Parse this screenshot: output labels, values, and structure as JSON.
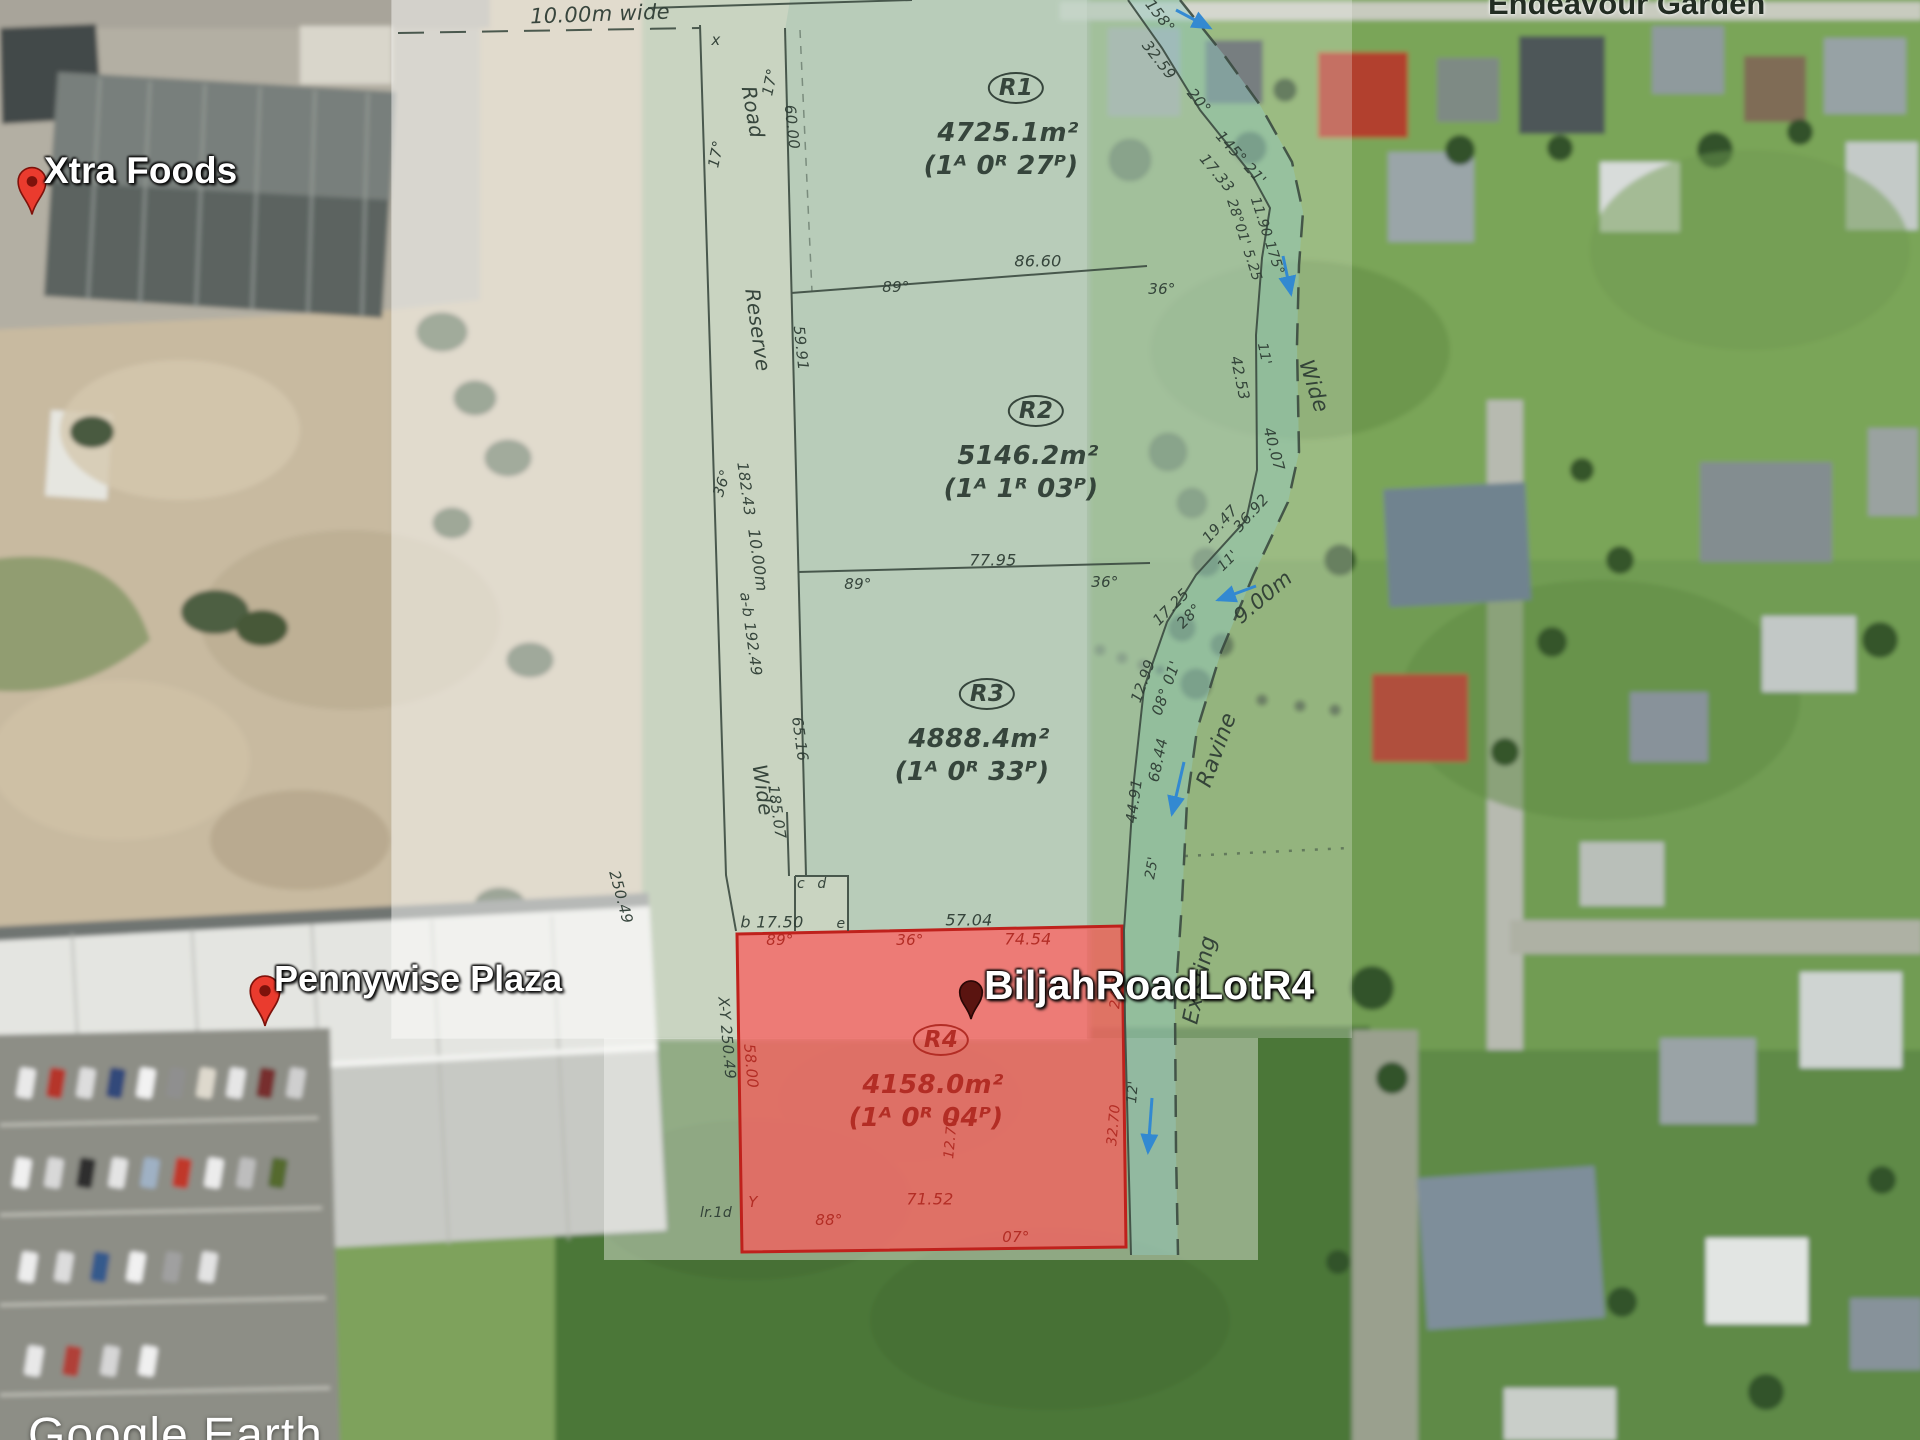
{
  "app": {
    "name": "Google Earth",
    "attribution": "Google Earth"
  },
  "placemarks": [
    {
      "id": "xtra-foods",
      "label": "Xtra Foods",
      "pin": "red-pin-icon"
    },
    {
      "id": "pennywise-plaza",
      "label": "Pennywise Plaza",
      "pin": "red-pin-icon"
    },
    {
      "id": "biljah-road-lot-r4",
      "label": "BiljahRoadLotR4",
      "pin": "dark-pin-icon"
    },
    {
      "id": "endeavour-garden",
      "label": "Endeavour Garden",
      "pin": null
    }
  ],
  "plan": {
    "colors": {
      "ink": "#2f3e35",
      "red": "#b02a22"
    },
    "lots": [
      {
        "id": "R1",
        "area_m2": "4725.1m²",
        "acreage": "(1ᴬ 0ᴿ 27ᴾ)",
        "x": 1016,
        "y": 88,
        "c": "ink"
      },
      {
        "id": "R2",
        "area_m2": "5146.2m²",
        "acreage": "(1ᴬ 1ᴿ 03ᴾ)",
        "x": 1036,
        "y": 411,
        "c": "ink"
      },
      {
        "id": "R3",
        "area_m2": "4888.4m²",
        "acreage": "(1ᴬ 0ᴿ 33ᴾ)",
        "x": 987,
        "y": 694,
        "c": "ink"
      },
      {
        "id": "R4",
        "area_m2": "4158.0m²",
        "acreage": "(1ᴬ 0ᴿ 04ᴾ)",
        "x": 941,
        "y": 1040,
        "c": "red"
      }
    ],
    "labels": [
      {
        "t": "10.00m wide",
        "x": 600,
        "y": 14,
        "s": 21,
        "r": -2
      },
      {
        "t": "x",
        "x": 716,
        "y": 40,
        "s": 15
      },
      {
        "t": "17°",
        "x": 770,
        "y": 82,
        "r": -78
      },
      {
        "t": "Road",
        "x": 753,
        "y": 112,
        "s": 20,
        "r": 80
      },
      {
        "t": "17°",
        "x": 716,
        "y": 154,
        "r": -78
      },
      {
        "t": "60.00",
        "x": 792,
        "y": 127,
        "r": 84
      },
      {
        "t": "Reserve",
        "x": 758,
        "y": 330,
        "s": 20,
        "r": 82
      },
      {
        "t": "59.91",
        "x": 801,
        "y": 348,
        "r": 84
      },
      {
        "t": "36°",
        "x": 722,
        "y": 483,
        "r": -72
      },
      {
        "t": "182.43",
        "x": 746,
        "y": 489,
        "r": 82
      },
      {
        "t": "10.00m",
        "x": 758,
        "y": 560,
        "s": 16,
        "r": 82
      },
      {
        "t": "a-b 192.49",
        "x": 751,
        "y": 634,
        "r": 82
      },
      {
        "t": "65.16",
        "x": 800,
        "y": 739,
        "r": 82
      },
      {
        "t": "Wide",
        "x": 763,
        "y": 790,
        "s": 20,
        "r": 82
      },
      {
        "t": "185.07",
        "x": 777,
        "y": 812,
        "r": 82
      },
      {
        "t": "250.49",
        "x": 621,
        "y": 897,
        "r": 75
      },
      {
        "t": "b 17.50",
        "x": 772,
        "y": 922,
        "s": 16
      },
      {
        "t": "c",
        "x": 801,
        "y": 884,
        "s": 14
      },
      {
        "t": "d",
        "x": 822,
        "y": 884,
        "s": 14
      },
      {
        "t": "e",
        "x": 841,
        "y": 924,
        "s": 14
      },
      {
        "t": "57.04",
        "x": 969,
        "y": 920,
        "s": 16
      },
      {
        "t": "X-Y 250.49",
        "x": 727,
        "y": 1038,
        "r": 85
      },
      {
        "t": "lr.1d",
        "x": 716,
        "y": 1213,
        "s": 14
      },
      {
        "t": "86.60",
        "x": 1038,
        "y": 261,
        "s": 16
      },
      {
        "t": "89°",
        "x": 896,
        "y": 287
      },
      {
        "t": "36°",
        "x": 1162,
        "y": 289
      },
      {
        "t": "77.95",
        "x": 993,
        "y": 560,
        "s": 16
      },
      {
        "t": "89°",
        "x": 858,
        "y": 584
      },
      {
        "t": "36°",
        "x": 1105,
        "y": 582
      },
      {
        "t": "158°",
        "x": 1160,
        "y": 16,
        "r": 52
      },
      {
        "t": "32.59",
        "x": 1159,
        "y": 60,
        "r": 52
      },
      {
        "t": "20°",
        "x": 1199,
        "y": 101,
        "r": 50
      },
      {
        "t": "145° 21'",
        "x": 1241,
        "y": 158,
        "r": 48
      },
      {
        "t": "17.33",
        "x": 1217,
        "y": 173,
        "r": 50
      },
      {
        "t": "28°01' 5.25",
        "x": 1244,
        "y": 240,
        "s": 14,
        "r": 72
      },
      {
        "t": "11.90 175°",
        "x": 1267,
        "y": 236,
        "s": 14,
        "r": 72
      },
      {
        "t": "11'",
        "x": 1264,
        "y": 354,
        "s": 14,
        "r": 78
      },
      {
        "t": "42.53",
        "x": 1240,
        "y": 378,
        "r": 78
      },
      {
        "t": "Wide",
        "x": 1314,
        "y": 386,
        "s": 21,
        "r": 72
      },
      {
        "t": "40.07",
        "x": 1274,
        "y": 449,
        "r": 75
      },
      {
        "t": "36.92",
        "x": 1251,
        "y": 513,
        "r": -48
      },
      {
        "t": "19.47",
        "x": 1220,
        "y": 524,
        "r": -48
      },
      {
        "t": "11'",
        "x": 1228,
        "y": 561,
        "s": 14,
        "r": -45
      },
      {
        "t": "28°",
        "x": 1189,
        "y": 616,
        "r": -45
      },
      {
        "t": "17.25",
        "x": 1171,
        "y": 607,
        "r": -45
      },
      {
        "t": "9.00m",
        "x": 1263,
        "y": 597,
        "s": 21,
        "r": -40
      },
      {
        "t": "12.99",
        "x": 1143,
        "y": 681,
        "r": -70
      },
      {
        "t": "08° 01'",
        "x": 1166,
        "y": 688,
        "r": -70
      },
      {
        "t": "68.44",
        "x": 1158,
        "y": 760,
        "r": -78
      },
      {
        "t": "44.91",
        "x": 1134,
        "y": 801,
        "r": -82
      },
      {
        "t": "25'",
        "x": 1152,
        "y": 868,
        "s": 14,
        "r": -80
      },
      {
        "t": "Ravine",
        "x": 1217,
        "y": 750,
        "s": 22,
        "r": -70
      },
      {
        "t": "Existing",
        "x": 1200,
        "y": 980,
        "s": 22,
        "r": -78
      },
      {
        "t": "12'",
        "x": 1133,
        "y": 1092,
        "s": 14,
        "r": -85
      },
      {
        "t": "89°",
        "x": 780,
        "y": 940,
        "c": "red"
      },
      {
        "t": "36°",
        "x": 910,
        "y": 940,
        "c": "red"
      },
      {
        "t": "74.54",
        "x": 1028,
        "y": 939,
        "s": 16,
        "c": "red"
      },
      {
        "t": "24.21",
        "x": 1117,
        "y": 988,
        "s": 14,
        "r": -85,
        "c": "red"
      },
      {
        "t": "58.00",
        "x": 751,
        "y": 1066,
        "r": 85,
        "c": "red"
      },
      {
        "t": "12.70",
        "x": 951,
        "y": 1138,
        "s": 14,
        "r": -85,
        "c": "red"
      },
      {
        "t": "32.70",
        "x": 1114,
        "y": 1125,
        "s": 14,
        "r": -85,
        "c": "red"
      },
      {
        "t": "71.52",
        "x": 930,
        "y": 1199,
        "s": 16,
        "c": "red"
      },
      {
        "t": "Y",
        "x": 753,
        "y": 1202,
        "c": "red"
      },
      {
        "t": "88°",
        "x": 829,
        "y": 1220,
        "c": "red"
      },
      {
        "t": "07°",
        "x": 1016,
        "y": 1237,
        "c": "red"
      }
    ]
  }
}
